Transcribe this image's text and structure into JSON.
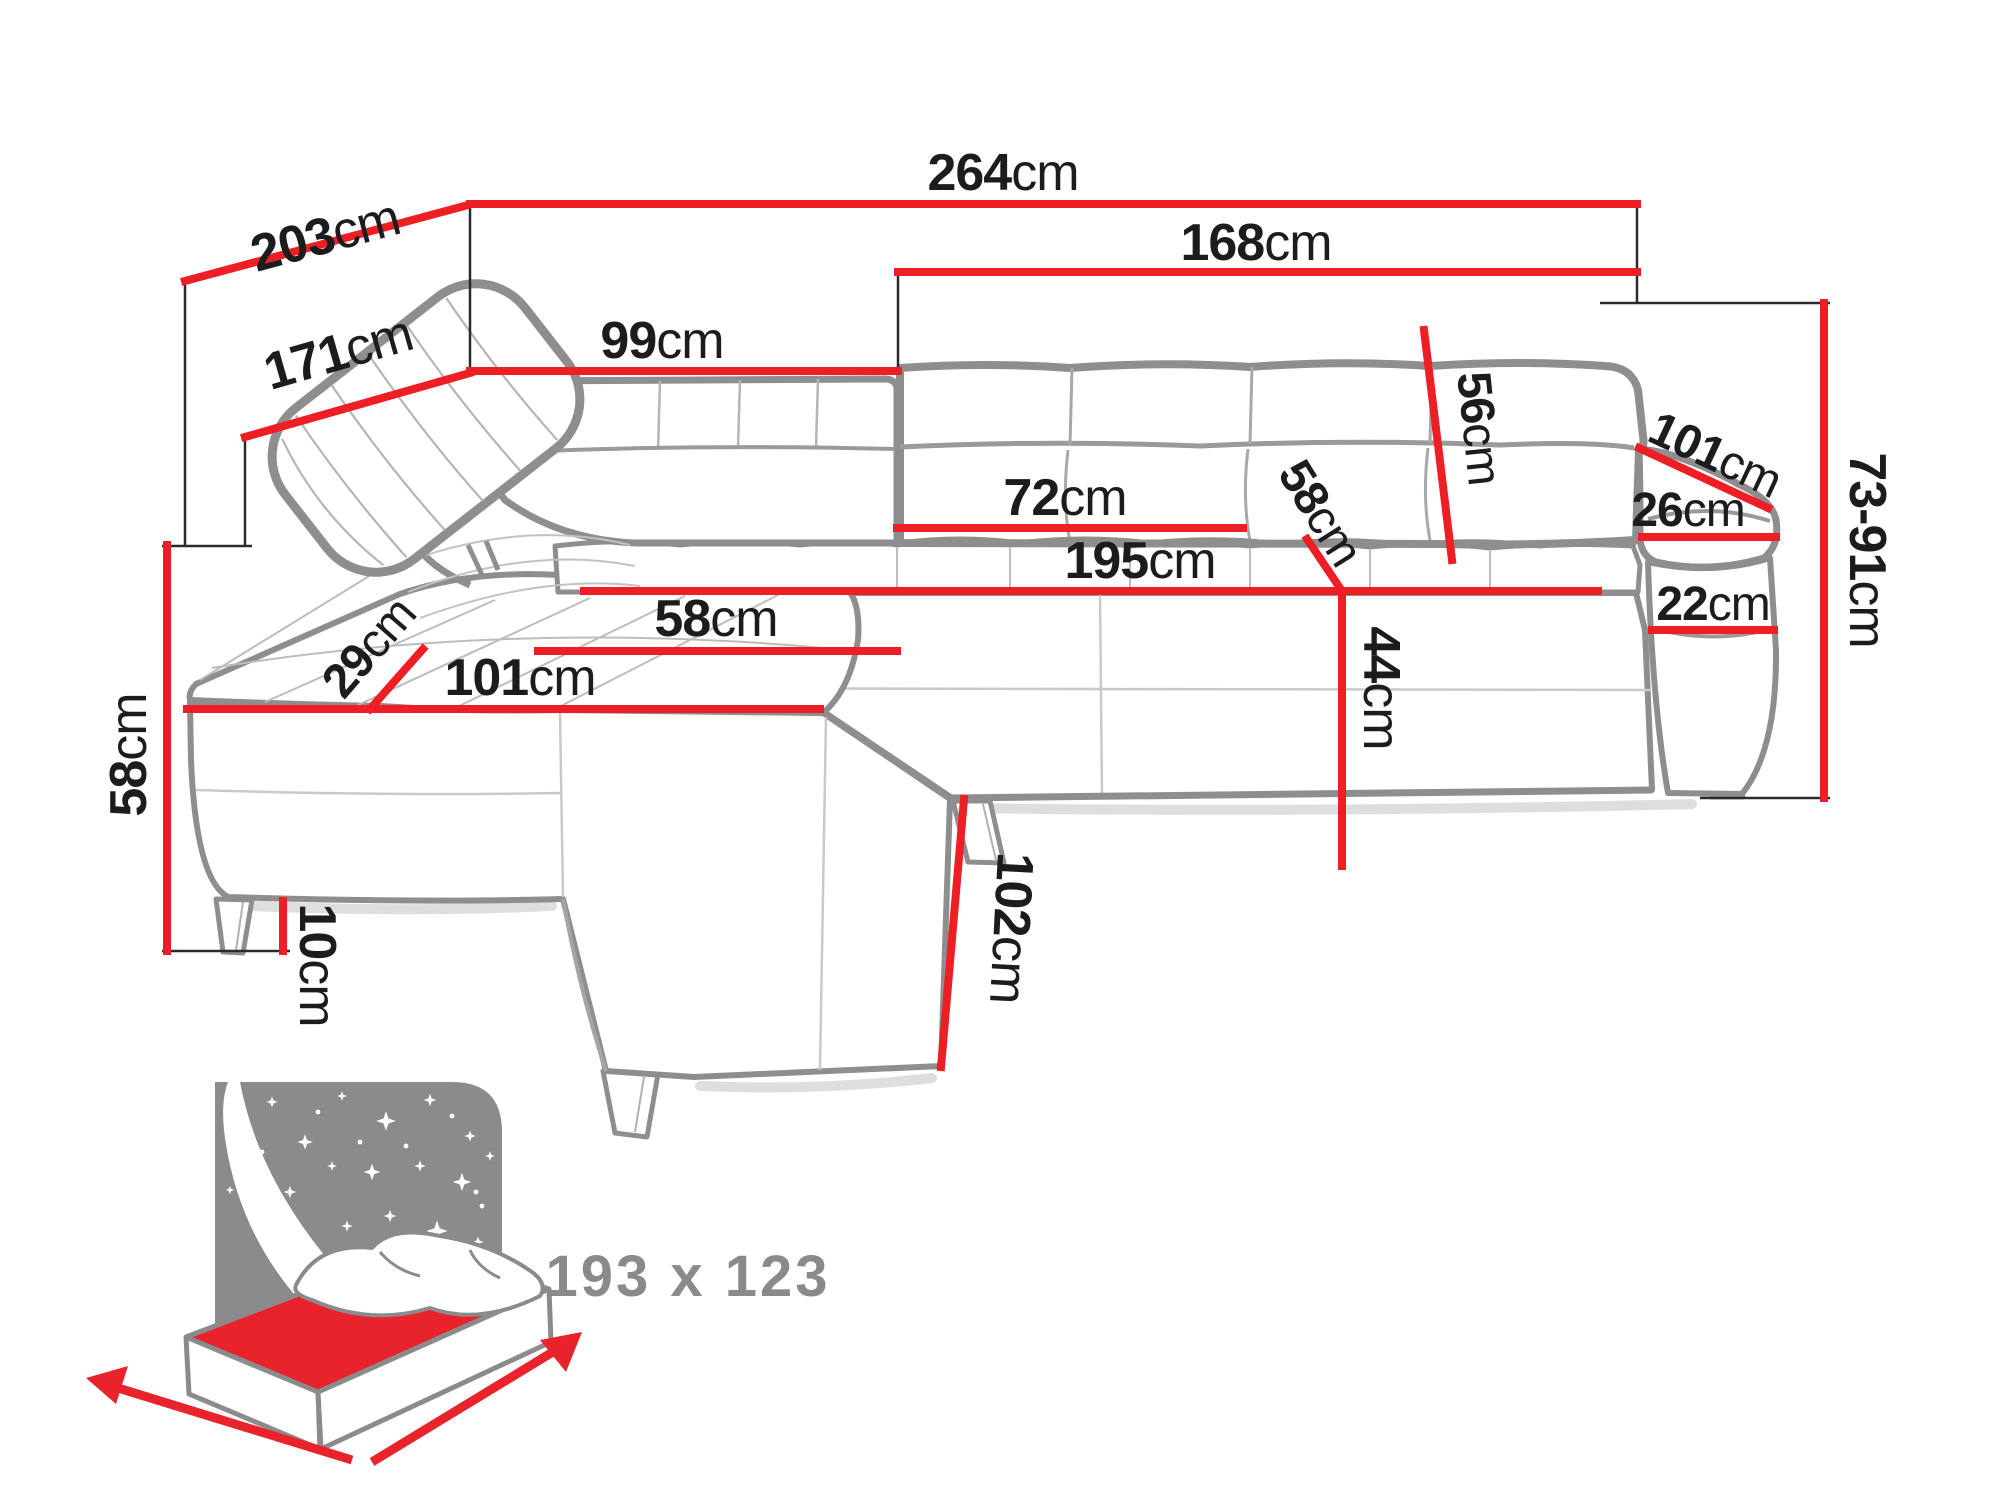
{
  "diagram": {
    "kind": "corner-sofa dimension drawing",
    "unit_default": "cm",
    "dimensions": [
      {
        "id": "total-width",
        "value": "264",
        "unit": "cm"
      },
      {
        "id": "total-depth",
        "value": "203",
        "unit": "cm"
      },
      {
        "id": "depth-to-backrest",
        "value": "171",
        "unit": "cm"
      },
      {
        "id": "chaise-back-width",
        "value": "99",
        "unit": "cm"
      },
      {
        "id": "main-back-width",
        "value": "168",
        "unit": "cm"
      },
      {
        "id": "backrest-height",
        "value": "56",
        "unit": "cm"
      },
      {
        "id": "armrest-length",
        "value": "101",
        "unit": "cm"
      },
      {
        "id": "armrest-top-width",
        "value": "26",
        "unit": "cm"
      },
      {
        "id": "armrest-front-height",
        "value": "22",
        "unit": "cm"
      },
      {
        "id": "height-range",
        "value": "73-91",
        "unit": "cm"
      },
      {
        "id": "back-cushion-width",
        "value": "72",
        "unit": "cm"
      },
      {
        "id": "seat-length",
        "value": "195",
        "unit": "cm"
      },
      {
        "id": "seat-depth-right",
        "value": "58",
        "unit": "cm"
      },
      {
        "id": "seat-height",
        "value": "44",
        "unit": "cm"
      },
      {
        "id": "chaise-seat-width",
        "value": "58",
        "unit": "cm"
      },
      {
        "id": "headrest-depth",
        "value": "29",
        "unit": "cm"
      },
      {
        "id": "chaise-seat-length",
        "value": "101",
        "unit": "cm"
      },
      {
        "id": "base-height",
        "value": "58",
        "unit": "cm"
      },
      {
        "id": "leg-height",
        "value": "10",
        "unit": "cm"
      },
      {
        "id": "chaise-total-depth",
        "value": "102",
        "unit": "cm"
      }
    ],
    "sleeping_area": {
      "label": "193 x 123",
      "icon": "bed-with-stars-icon"
    },
    "colors": {
      "dimension_red": "#ed1f24",
      "outline_gray": "#8e8e8e",
      "label_black": "#1c1c1c",
      "icon_gray": "#8b8b8b",
      "mattress_red": "#e8232b"
    }
  }
}
